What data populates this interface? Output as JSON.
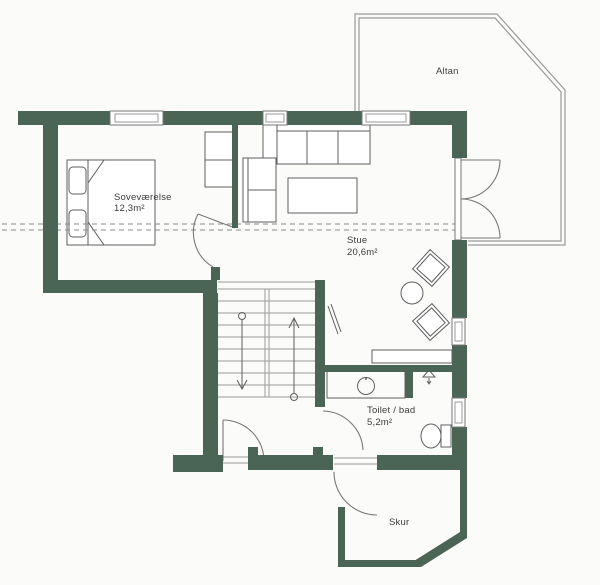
{
  "document": {
    "type": "floor-plan-scan"
  },
  "colors": {
    "wall": "#4a6455",
    "line": "#5f5f5f",
    "balcony_line": "#9a9a9a",
    "dash": "#8a8a8a",
    "text": "#3c3c3c",
    "background": "#fbfbf9"
  },
  "rooms": {
    "altan": {
      "label": "Altan"
    },
    "bedroom": {
      "label": "Soveværelse",
      "area": "12,3m²"
    },
    "living": {
      "label": "Stue",
      "area": "20,6m²"
    },
    "bath": {
      "label": "Toilet / bad",
      "area": "5,2m²"
    },
    "shed": {
      "label": "Skur"
    }
  }
}
